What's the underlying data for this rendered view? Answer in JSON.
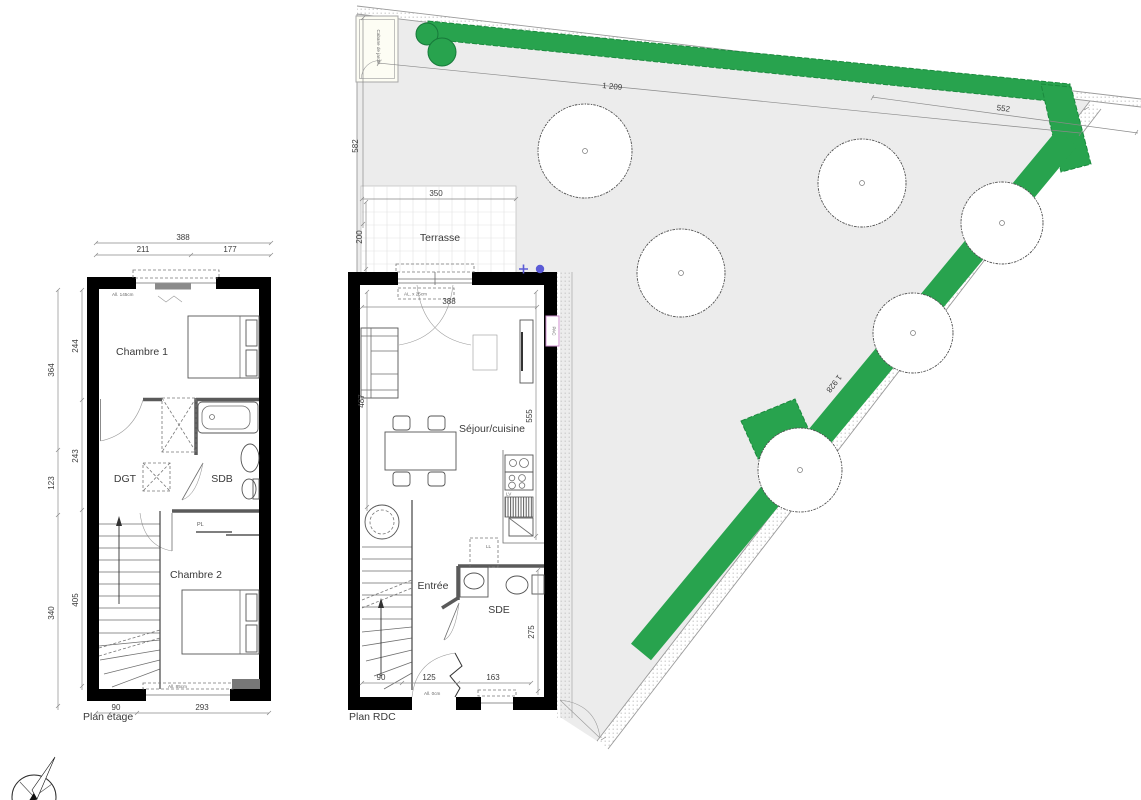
{
  "colors": {
    "hedge_green": "#28a34e",
    "hedge_green_dark": "#1b8a3e",
    "parcel_gray": "#ececec",
    "wall_black": "#000000",
    "pac_pink": "#cf8fcf",
    "marker_blue": "#5b5bd6"
  },
  "plan_etage": {
    "title": "Plan étage",
    "rooms": {
      "chambre1": "Chambre 1",
      "dgt": "DGT",
      "sdb": "SDB",
      "chambre2": "Chambre 2"
    },
    "labels": {
      "closet": "PL",
      "window_top": "All. 145cm",
      "window_bottom": "All. 85cm"
    },
    "dims": {
      "total_width": "388",
      "width_left": "211",
      "width_right": "177",
      "outer_left": [
        "364",
        "123",
        "340"
      ],
      "inner_left": [
        "244",
        "243",
        "405"
      ],
      "bottom_stair": "90",
      "bottom": "293"
    }
  },
  "plan_rdc": {
    "title": "Plan RDC",
    "rooms": {
      "sejour": "Séjour/cuisine",
      "entree": "Entrée",
      "sde": "SDE"
    },
    "labels": {
      "pac": "PAC",
      "dishwasher": "LV",
      "laundry": "LL",
      "window_top": "AL. x 25cm",
      "door_sill": "All. 0cm"
    },
    "dims": {
      "top_width": "388",
      "left_height": "487",
      "right_height": "555",
      "sde_height": "275",
      "bottom": [
        "90",
        "125",
        "163"
      ]
    }
  },
  "garden": {
    "labels": {
      "cabane": "Cabane de jardin",
      "terrasse": "Terrasse"
    },
    "dims": {
      "top_boundary": "1 209",
      "right_boundary": "552",
      "left_boundary": "582",
      "diagonal_boundary": "1 928",
      "terrasse_width": "350",
      "terrasse_depth": "200"
    }
  }
}
